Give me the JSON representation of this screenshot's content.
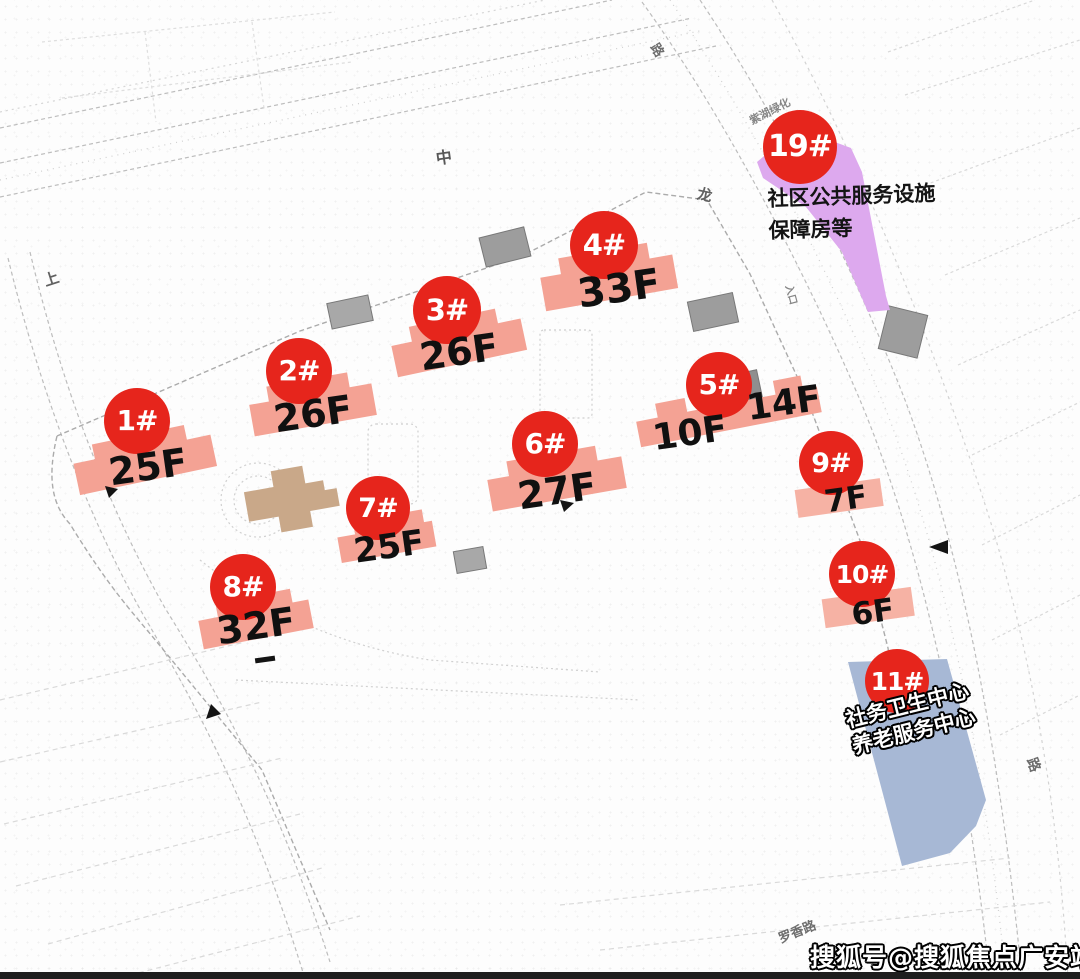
{
  "map": {
    "markers": [
      {
        "id": "1#",
        "floors": "25F"
      },
      {
        "id": "2#",
        "floors": "26F"
      },
      {
        "id": "3#",
        "floors": "26F"
      },
      {
        "id": "4#",
        "floors": "33F"
      },
      {
        "id": "5#",
        "floors_left": "10F",
        "floors_right": "14F"
      },
      {
        "id": "6#",
        "floors": "27F"
      },
      {
        "id": "7#",
        "floors": "25F"
      },
      {
        "id": "8#",
        "floors": "32F"
      },
      {
        "id": "9#",
        "floors": "7F"
      },
      {
        "id": "10#",
        "floors": "6F"
      }
    ],
    "parcels": [
      {
        "id": "19#",
        "lines": [
          "社区公共服务设施",
          "保障房等"
        ],
        "color": "#dda9ee"
      },
      {
        "id": "11#",
        "lines": [
          "社务卫生中心",
          "养老服务中心"
        ],
        "color": "#a7b8d5"
      }
    ],
    "road_labels": {
      "zhong": "中",
      "lu_top": "路",
      "long": "龙",
      "shang": "上",
      "zihu": "紫湖绿化",
      "luoxiang": "罗香路",
      "lu_right": "路",
      "rukou": "入口"
    },
    "watermark": "搜狐号@搜狐焦点广安站",
    "colors": {
      "badge_red": "#e6251c",
      "building_salmon": "#f4a294",
      "building_salmon_light": "#f6b2a4",
      "clubhouse_tan": "#c9a889",
      "parcel_purple": "#dda9ee",
      "parcel_blue": "#a7b8d5"
    }
  }
}
